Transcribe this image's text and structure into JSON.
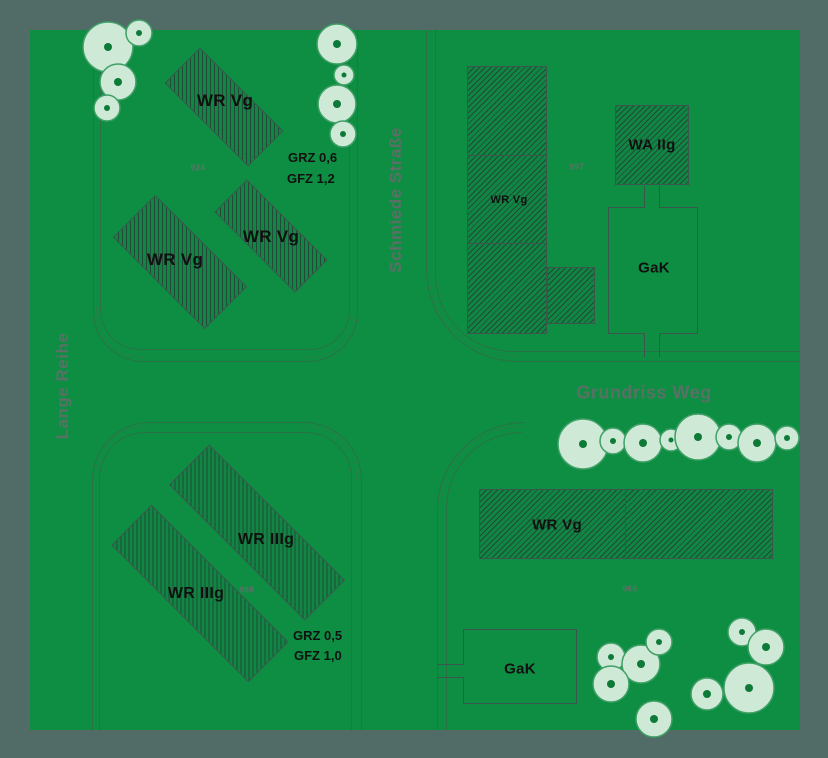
{
  "streets": {
    "lange_reihe": "Lange Reihe",
    "schmiede_strasse": "Schmiede Straße",
    "grundriss_weg": "Grundriss Weg"
  },
  "zones": {
    "tl_building_1": "WR Vg",
    "tl_building_2": "WR Vg",
    "tl_building_3": "WR Vg",
    "tr_residential": "WR Vg",
    "tr_apartment": "WA IIg",
    "tr_garage": "GaK",
    "bl_building_1": "WR IIIg",
    "bl_building_2": "WR IIIg",
    "br_residential": "WR Vg",
    "br_garage": "GaK"
  },
  "annotations": {
    "tl_grz": "GRZ 0,6",
    "tl_gfz": "GFZ 1,2",
    "bl_grz": "GRZ 0,5",
    "bl_gfz": "GFZ 1,0",
    "tl_parcel": "924",
    "tr_parcel": "997",
    "bl_parcel": "998",
    "br_parcel": "966"
  },
  "colors": {
    "canvas_green": "#0e8e43",
    "margin_gray": "#516c66",
    "hatch_fill": "#0f8742",
    "hatch_line": "#26473e",
    "shape_border": "#3c564d",
    "curb_line": "#2a7246",
    "tree_fill": "#cfe9d7",
    "tree_stroke": "#3fa066",
    "tree_dot": "#0d7a38",
    "label_black": "#101010",
    "street_label": "#5a7066"
  },
  "trees": {
    "top_left_cluster": [
      {
        "x": 108,
        "y": 47,
        "r": 25
      },
      {
        "x": 139,
        "y": 33,
        "r": 13
      },
      {
        "x": 118,
        "y": 82,
        "r": 18
      },
      {
        "x": 107,
        "y": 108,
        "r": 13
      }
    ],
    "schmiede_cluster": [
      {
        "x": 337,
        "y": 44,
        "r": 20
      },
      {
        "x": 344,
        "y": 75,
        "r": 10
      },
      {
        "x": 337,
        "y": 104,
        "r": 19
      },
      {
        "x": 343,
        "y": 134,
        "r": 13
      }
    ],
    "grundriss_row": [
      {
        "x": 583,
        "y": 444,
        "r": 25
      },
      {
        "x": 613,
        "y": 441,
        "r": 13
      },
      {
        "x": 643,
        "y": 443,
        "r": 19
      },
      {
        "x": 671,
        "y": 440,
        "r": 11
      },
      {
        "x": 698,
        "y": 437,
        "r": 23
      },
      {
        "x": 729,
        "y": 437,
        "r": 13
      },
      {
        "x": 757,
        "y": 443,
        "r": 19
      },
      {
        "x": 787,
        "y": 438,
        "r": 12
      }
    ],
    "bottom_right_cluster": [
      {
        "x": 611,
        "y": 657,
        "r": 14
      },
      {
        "x": 641,
        "y": 664,
        "r": 19
      },
      {
        "x": 659,
        "y": 642,
        "r": 13
      },
      {
        "x": 611,
        "y": 684,
        "r": 18
      },
      {
        "x": 654,
        "y": 719,
        "r": 18
      },
      {
        "x": 707,
        "y": 694,
        "r": 16
      },
      {
        "x": 742,
        "y": 632,
        "r": 14
      },
      {
        "x": 766,
        "y": 647,
        "r": 18
      },
      {
        "x": 749,
        "y": 688,
        "r": 25
      }
    ]
  }
}
